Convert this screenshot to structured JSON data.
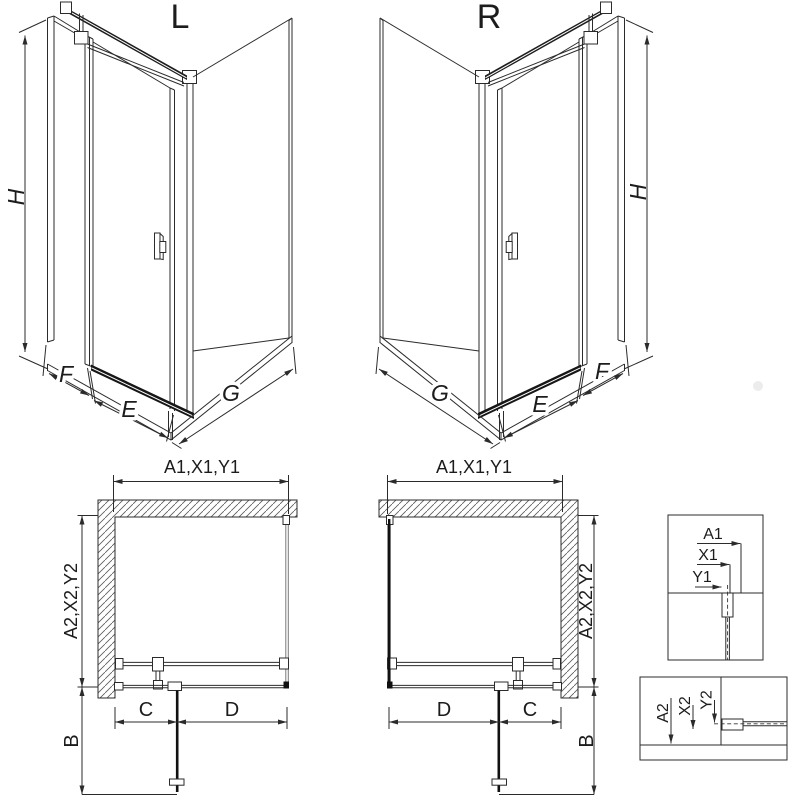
{
  "drawing": {
    "background": "#ffffff",
    "line_color": "#2b2b2b",
    "dark_color": "#111111",
    "glass_line_color": "#7a7a7a",
    "iso_left": {
      "label": "L",
      "dim_height": "H",
      "dim_side_panel": "F",
      "dim_door": "E",
      "dim_return_panel": "G"
    },
    "iso_right": {
      "label": "R",
      "dim_height": "H",
      "dim_side_panel": "F",
      "dim_door": "E",
      "dim_return_panel": "G"
    },
    "plan_left": {
      "dim_top": "A1,X1,Y1",
      "dim_side": "A2,X2,Y2",
      "dim_c": "C",
      "dim_d": "D",
      "dim_b": "B"
    },
    "plan_right": {
      "dim_top": "A1,X1,Y1",
      "dim_side": "A2,X2,Y2",
      "dim_c": "C",
      "dim_d": "D",
      "dim_b": "B"
    },
    "detail_profile_top": {
      "dim_a": "A1",
      "dim_x": "X1",
      "dim_y": "Y1"
    },
    "detail_profile_bottom": {
      "dim_a": "A2",
      "dim_x": "X2",
      "dim_y": "Y2"
    }
  }
}
